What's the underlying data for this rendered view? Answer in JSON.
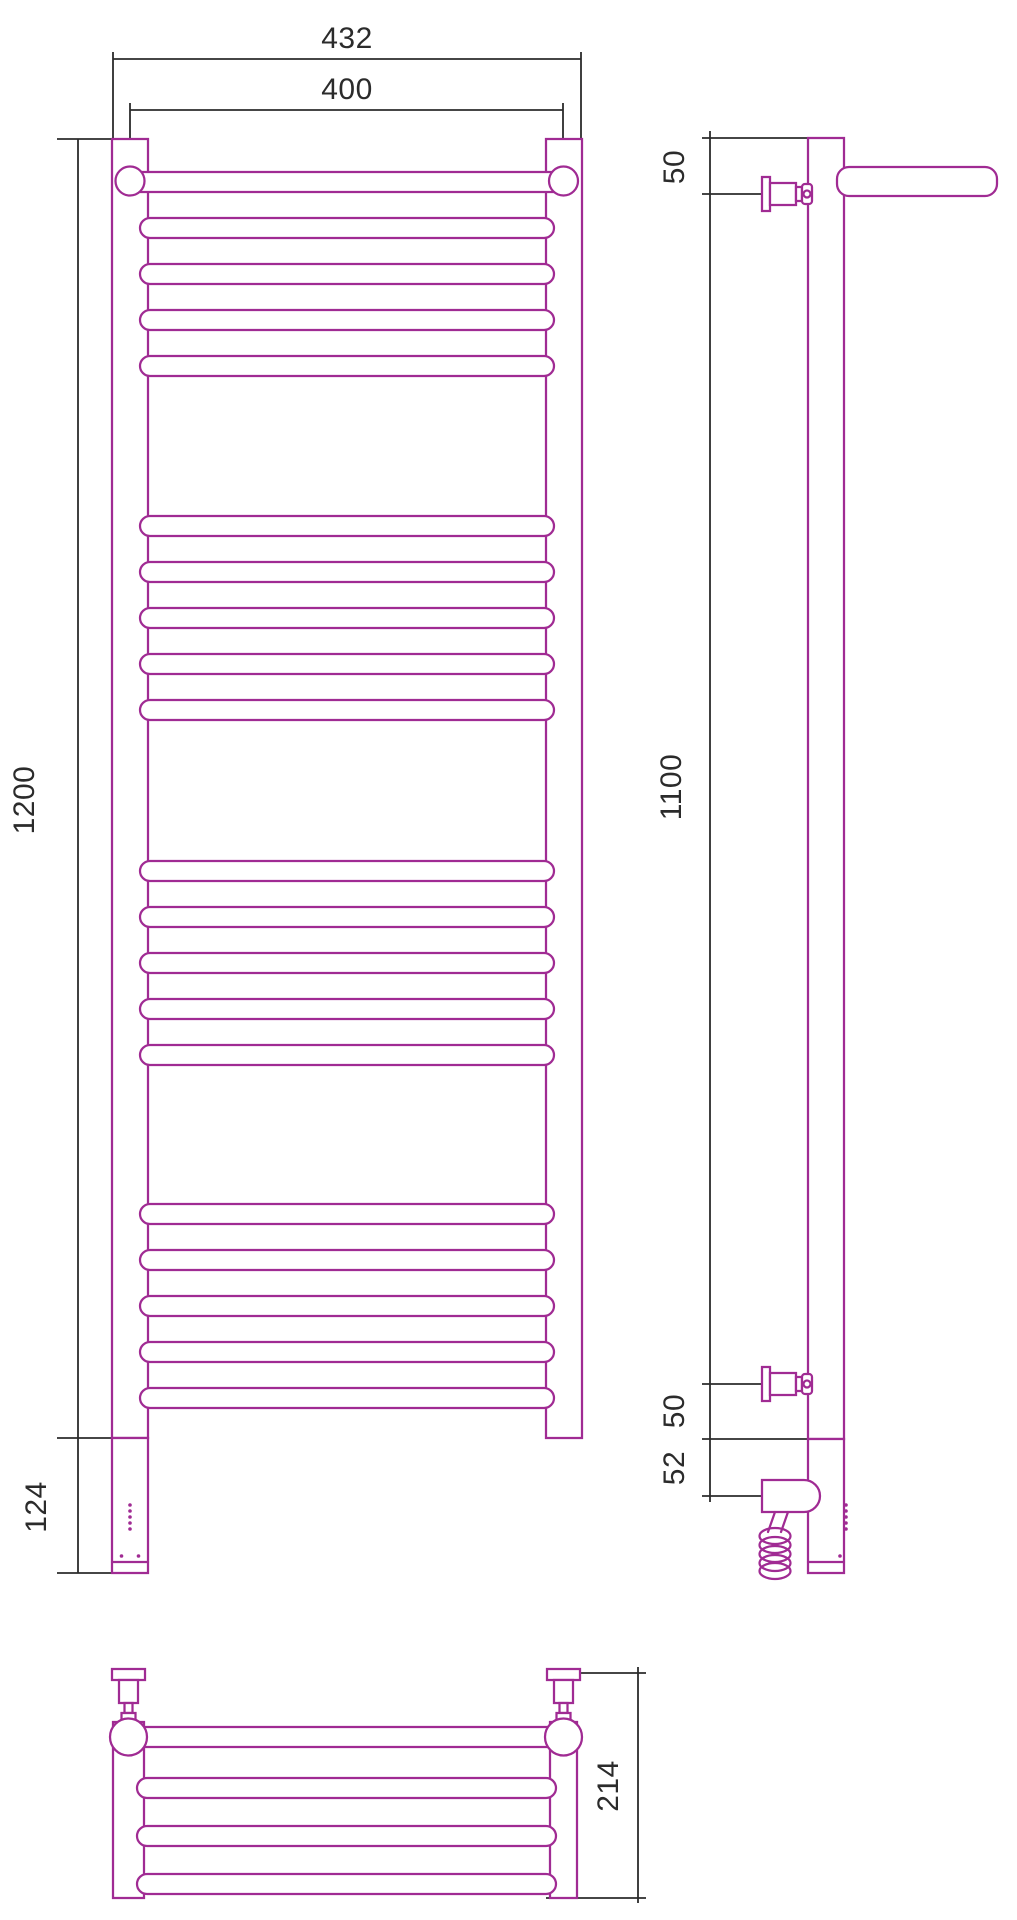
{
  "colors": {
    "outline": "#A02B93",
    "dimension": "#2B2B2B",
    "background": "#FFFFFF"
  },
  "front_view": {
    "dim_overall_width": "432",
    "dim_rail_axis_width": "400",
    "dim_body_height": "1200",
    "dim_heating_unit_height": "124"
  },
  "side_view": {
    "dim_top_bracket_offset": "50",
    "dim_bracket_span": "1100",
    "dim_bottom_bracket_offset": "50",
    "dim_heating_element_offset": "52"
  },
  "top_view": {
    "dim_shelf_depth": "214"
  }
}
